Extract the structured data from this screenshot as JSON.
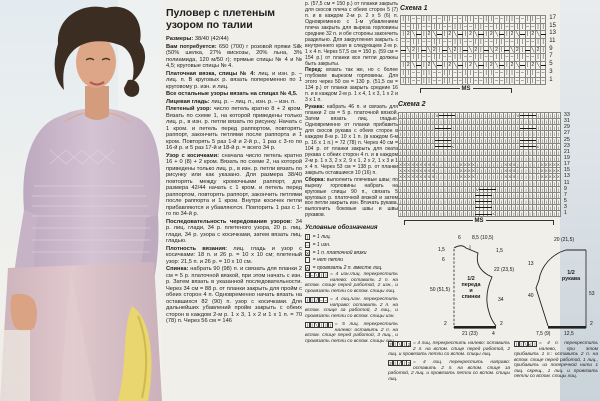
{
  "article": {
    "title": "Пуловер с плетеным узором по талии",
    "col1": [
      {
        "lead": "Размеры:",
        "text": "38/40 (42/44)"
      },
      {
        "lead": "Вам потребуется:",
        "text": "650 (700) г розовой пряжи Silk (50% шелка, 27% вискозы, 20% льна, 3% полиамида, 120 м/50 г); прямые спицы № 4 и № 4,5; круговые спицы № 4."
      },
      {
        "lead": "Платочная вязка, спицы № 4:",
        "text": "лиц. и изн. р. – лиц. п. В круговых р. вязать попеременно по 1 круговому р. изн. и лиц."
      },
      {
        "lead": "Все остальные узоры вязать на спицах № 4,5.",
        "text": ""
      },
      {
        "lead": "Лицевая гладь:",
        "text": "лиц. р. – лиц. п., изн. р. – изн. п."
      },
      {
        "lead": "Плетеный узор:",
        "text": "число петель кратно 8 + 2 кром. Вязать по схеме 1, на которой приведены только лиц. р., в изн. р. петли вязать по рисунку. Начать с 1 кром. и петель перед раппортом, повторять раппорт, закончить петлями после раппорта и 1 кром. Повторять 5 раз 1-й и 2-й р., 1 раз с 3-го по 16-й р. и 5 раз 17-й и 18-й р. = всего 34 р."
      },
      {
        "lead": "Узор с косичками:",
        "text": "сначала число петель кратно 16 + 0 (8) + 2 кром. Вязать по схеме 2, на которой приведены только лиц. р., в изн. р. петли вязать по рисунку или как указано. Для размера 38/40 повторять между кромочными раппорт, для размера 42/44 начать с 1 кром. и петель перед раппортом, повторять раппорт, закончить петлями после раппорта и 1 кром. Внутри косичек петли прибавляются и убавляются. Повторить 1 раз с 1-го по 34-й р."
      },
      {
        "lead": "Последовательность чередования узоров:",
        "text": "34 р. лиц. глади, 34 р. плетеного узора, 20 р. лиц. глади, 34 р. узора с косичками, затем вязать лиц. гладью."
      },
      {
        "lead": "Плотность вязания:",
        "text": "лиц. гладь и узор с косичками: 18 п. и 26 р. = 10 х 10 см; плетеный узор: 21,5 п. и 26 р. = 10 х 10 см."
      },
      {
        "lead": "Спинка:",
        "text": "набрать 90 (98) п. и связать для планки 2 см = 5 р. платочной вязкой, при этом начать с изн. р. Затем вязать в указанной последовательности. Через 34 см = 88 р. от планки закрыть для пройм с обеих сторон 4 п. Одновременно начать вязать на оставшихся 82 (90) п. узор с косичками. Для дальнейших убавлений пройм закрыть с обеих сторон в каждом 2-м р. 1 х 3, 1 х 2 и 1 х 1 п. = 70 (78) п. Через 56 см = 146"
      }
    ],
    "col2": [
      {
        "lead": "",
        "text": "р. (57,5 см = 150 р.) от планки закрыть для скосов плеча с обеих сторон 5 (7) п. и в каждом 2-м р. 2 х 5 (6) п. Одновременно с 1-м убавлением плеча закрыть для выреза горловины средние 32 п. и обе стороны закончить раздельно. Для закругления закрыть с внутреннего края в следующем 2-м р. 1 х 4 п. Через 57,5 см = 150 р. (59 см = 154 р.) от планки все петли должны быть закрыты."
      },
      {
        "lead": "Перед:",
        "text": "вязать так же, но с более глубоким вырезом горловины. Для этого через 50 см = 130 р. (51,5 см = 134 р.) от планки закрыть средние 16 п. и в каждом 2-м р. 1 х 4, 1 х 3, 1 х 2 и 3 х 1 п."
      },
      {
        "lead": "Рукава:",
        "text": "набрать 46 п. и связать для планки 2 см = 5 р. платочной вязкой. Затем вязать лиц. гладью. Одновременно от планки прибавить для скосов рукава с обеих сторон в каждом 8-м р. 10 х 1 п. (в каждом 6-м р. 16 х 1 п.) = 72 (78) п. Через 40 см = 104 р. от планки закрыть для оката рукава с обеих сторон 4 п. и в каждом 2-м р. 1 х 3, 2 х 2, 9 х 1, 2 х 2, 1 х 3 и 1 х 4 п. Через 53 см = 138 р. от планки закрыть оставшиеся 10 (16) п."
      },
      {
        "lead": "Сборка:",
        "text": "выполнить плечевые швы; по вырезу горловины набрать на круговые спицы 90 п., связать 5 круговых р. платочной вязкой и затем все петли закрыть изн. Втачать рукава, выполнить боковые швы и швы рукавов."
      }
    ]
  },
  "legend": {
    "title": "Условные обозначения",
    "simple": [
      {
        "sym": "|",
        "text": "= 1 лиц."
      },
      {
        "sym": "-",
        "text": "= 1 изн."
      },
      {
        "sym": "X",
        "text": "= 1 п. платочной вязки"
      },
      {
        "sym": ".",
        "text": "= нет петли"
      },
      {
        "sym": "Λ",
        "text": "= провязать 2 п. вместе лиц."
      }
    ],
    "complex": [
      {
        "sym": "--\\||",
        "text": "= 4 изн./лиц. перекрестить налево: оставить 2 п. на вспом. спице перед работой, 2 изн., и провязать петли со вспом. спицы лиц."
      },
      {
        "sym": "||/--",
        "text": "= 4 лиц./изн. перекрестить направо: оставить 2 п. на вспом. спице за работой, 2 лиц., и провязать петли со вспом. спицы изн."
      },
      {
        "sym": "||\\|||",
        "text": "= 5 лиц. перекрестить налево: оставить 2 п. на вспом. спице перед работой, 3 лиц., и провязать петли со вспом. спицы лиц."
      }
    ],
    "bottom": [
      {
        "sym": "2|\\|2",
        "text": "= 4 лиц. перекрестить налево: оставить 2 п. на вспом. спице перед работой, 2 лиц. и провязать петли со вспом. спицы лиц."
      },
      {
        "sym": "2|/|2",
        "text": "= 4 лиц. перекрестить направо: оставить 2 п. на вспом. спице за работой, 2 лиц. и провязать петли со вспом. спицы лиц."
      },
      {
        "sym": "||\\Z|",
        "text": "= 4 п. перекрестить налево, при этом прибавить 1 п.: оставить 2 п. на вспом. спице перед работой, 1 лиц., прибавить из поперечной нити 1 лиц. скрещ., 1 лиц. и провязать петли со вспом. спицы лиц."
      }
    ]
  },
  "charts": [
    {
      "label": "Схема 1",
      "ms": "MS",
      "numbers": [
        17,
        15,
        13,
        11,
        9,
        7,
        5,
        3,
        1
      ],
      "rows": [
        "||--||--||--||--||--||--||--",
        "--||--||--||--||--||--||--||",
        "|2\\=|2\\=|2\\=|2\\=|2\\=|2\\=|2\\=",
        "--||--||--||--||--||--||--||",
        "=\\2|=\\2|=\\2|=\\2|=\\2|=\\2|=\\2|",
        "--||--||--||--||--||--||--||",
        "|2\\=|2\\=|2\\=|2\\=|2\\=|2\\=|2\\=",
        "||--||--||--||--||--||--||--",
        "||--||--||--||--||--||--||--"
      ]
    },
    {
      "label": "Схема 2",
      "ms": "MS",
      "numbers": [
        33,
        31,
        29,
        27,
        25,
        23,
        21,
        19,
        17,
        15,
        13,
        11,
        9,
        7,
        5,
        3,
        1
      ],
      "rows": [
        "|||||||||V====|||||||||||||||V====||||||",
        "||||||||||||||||||||||||||||||||||||||||",
        "|||||||||====|||||||||||||||||====||||||",
        "||||||||||||||||||||||||||||||||||||||||",
        "|||||||||====|||||||||||||||||====||||||",
        "|||||||||====Z||||||||||||||||====Z|||||",
        "||||||||||||||||||||||||||||||||||||||||",
        "||||||||||||||||||||||||||||||||||||||||",
        "XXXXXXXXX||||||XXXX|||||||XXX||||||XXXXX",
        "XXXXXXXXX||||||XXXX|||||||XXX||||||XXXXX",
        "XXXXXXXXX||||||XXXX|||||||XXX||||||XXXXX",
        "||||||||||||||||||||||||||||||||||||||||",
        "|||||||||||||||||||V====||||||||||||||||",
        "|||||||||||||||||||====|||||||||||||||||",
        "|||||||||||||||||||====|||||||||||||||||",
        "|||||||||||||||||||====|||||||||||||||||",
        "|||||||||||||||||||====Z||||||||||||||||"
      ]
    }
  ],
  "schematics": {
    "front": {
      "name1": "1/2",
      "name2": "переда",
      "name3": "и",
      "name4": "спинки",
      "top_left": "6",
      "top_mid": "8,5 (10,5)",
      "left_1": "1,5",
      "left_2": "6",
      "left_mid": "50 (51,5)",
      "left_bottom": "2",
      "right_top": "1,5",
      "right_upper": "22 (23,5)",
      "right_lower": "34",
      "right_bottom": "2",
      "bottom_main": "21 (23)",
      "bottom_side": "4"
    },
    "sleeve": {
      "name1": "1/2",
      "name2": "рукава",
      "top": "20 (21,5)",
      "left_top": "13",
      "left_mid": "40",
      "right": "53",
      "right_bottom": "2",
      "bottom_left": "7,5 (9)",
      "bottom_right": "12,5"
    }
  },
  "colors": {
    "paper": "#f1efe9",
    "sweater": "#c9b6c9",
    "skirt": "#d9bfc7",
    "accent_yellow": "#e9d66f"
  }
}
